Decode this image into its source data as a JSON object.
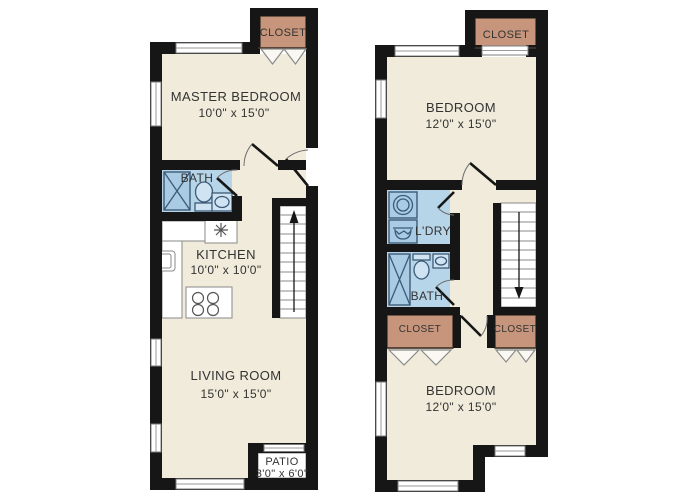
{
  "colors": {
    "floor": "#f0ebda",
    "wall": "#161616",
    "wet": "#b7d5e9",
    "closet": "#c6957b",
    "fixture": "#a9cbe4",
    "fixline": "#3c5a77",
    "text": "#333333"
  },
  "floor1": {
    "closet": {
      "label": "CLOSET"
    },
    "master_bedroom": {
      "label": "MASTER BEDROOM",
      "dims": "10'0\" x 15'0\""
    },
    "bath": {
      "label": "BATH"
    },
    "kitchen": {
      "label": "KITCHEN",
      "dims": "10'0\" x 10'0\""
    },
    "living_room": {
      "label": "LIVING ROOM",
      "dims": "15'0\" x 15'0\""
    },
    "patio": {
      "label": "PATIO",
      "dims": "3'0\" x 6'0\""
    }
  },
  "floor2": {
    "closet_top": {
      "label": "CLOSET"
    },
    "bedroom_top": {
      "label": "BEDROOM",
      "dims": "12'0\" x 15'0\""
    },
    "laundry": {
      "label": "L'DRY"
    },
    "bath": {
      "label": "BATH"
    },
    "closet_left": {
      "label": "CLOSET"
    },
    "closet_right": {
      "label": "CLOSET"
    },
    "bedroom_bottom": {
      "label": "BEDROOM",
      "dims": "12'0\" x 15'0\""
    }
  }
}
